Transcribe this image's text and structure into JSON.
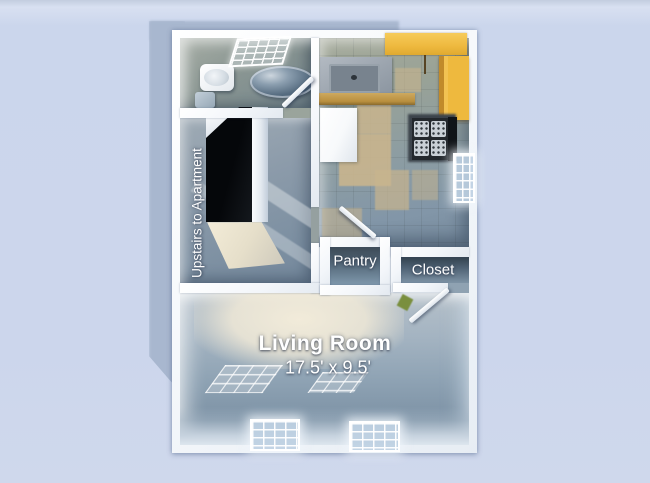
{
  "title": "Apartment floor plan 3D render",
  "labels": {
    "stairs_note": "Upstairs to Apartment",
    "pantry": "Pantry",
    "closet": "Closet",
    "living_room": "Living Room",
    "living_room_size": "17.5' x 9.5'"
  },
  "rooms": [
    "bathroom",
    "kitchen",
    "stair-hall",
    "pantry",
    "closet",
    "living-room"
  ],
  "fixtures": [
    "bathroom-sink",
    "toilet",
    "round-bathtub",
    "kitchen-sink-counter",
    "refrigerator",
    "stove",
    "yellow-cabinets",
    "windows",
    "stairwell"
  ],
  "colors": {
    "background": "#cdd7ec",
    "shadow": "#a8b7cf",
    "wall": "#f5f8fb",
    "floor_blue": "#8ba0b3",
    "tile_beige": "#c9b58e",
    "cabinet_yellow": "#eeb93e",
    "cabinet_front": "#c18a2a",
    "stairwell_black": "#0a0d10",
    "light_cream": "#efe8d5"
  }
}
